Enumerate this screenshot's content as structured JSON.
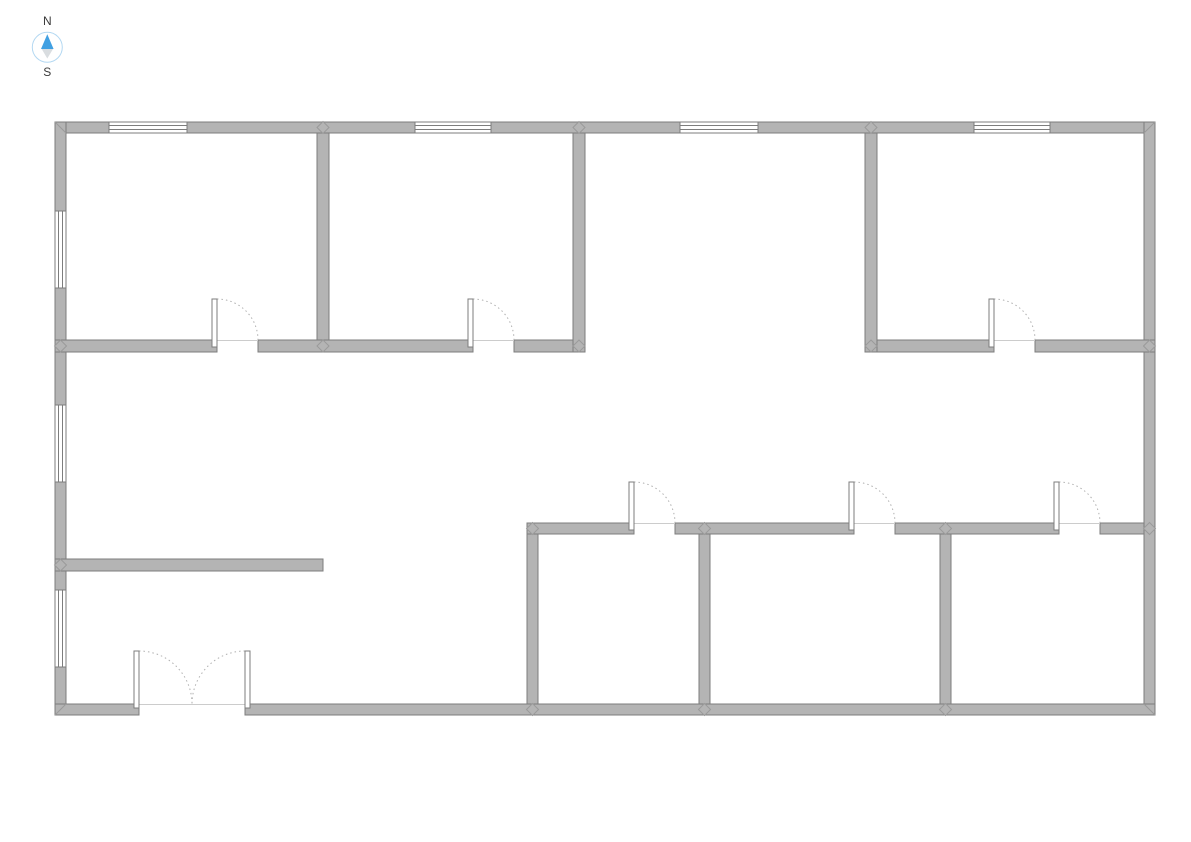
{
  "compass": {
    "north_label": "N",
    "south_label": "S",
    "needle_north_color": "#41a0e2",
    "needle_south_color": "#d9dde0",
    "ring_color": "#b3d8f2",
    "label_color": "#3a3a3a"
  },
  "plan": {
    "colors": {
      "background": "#ffffff",
      "wall_fill": "#b4b4b4",
      "wall_stroke": "#7d7d7d",
      "opening_fill": "#ffffff",
      "door_arc": "#b0b0b0",
      "threshold": "#cccccc",
      "joint_stroke": "#9a9a9a"
    },
    "walls": [
      {
        "name": "outer-wall-north",
        "r": [
          55,
          122,
          1100,
          11
        ]
      },
      {
        "name": "outer-wall-west",
        "r": [
          55,
          122,
          11,
          593
        ]
      },
      {
        "name": "outer-wall-east",
        "r": [
          1144,
          122,
          11,
          593
        ]
      },
      {
        "name": "outer-wall-south-west-segment",
        "r": [
          55,
          704,
          84,
          11
        ]
      },
      {
        "name": "outer-wall-south-east-segment",
        "r": [
          245,
          704,
          910,
          11
        ]
      },
      {
        "name": "partition-upper-west-1",
        "r": [
          55,
          340,
          162,
          12
        ]
      },
      {
        "name": "partition-upper-west-2",
        "r": [
          258,
          340,
          215,
          12
        ]
      },
      {
        "name": "partition-upper-west-3",
        "r": [
          514,
          340,
          71,
          12
        ]
      },
      {
        "name": "partition-upper-east-1",
        "r": [
          865,
          340,
          129,
          12
        ]
      },
      {
        "name": "partition-upper-east-2",
        "r": [
          1035,
          340,
          120,
          12
        ]
      },
      {
        "name": "divider-room1-room2",
        "r": [
          317,
          133,
          12,
          207
        ]
      },
      {
        "name": "divider-room2-hall",
        "r": [
          573,
          133,
          12,
          219
        ]
      },
      {
        "name": "divider-hall-room4",
        "r": [
          865,
          133,
          12,
          219
        ]
      },
      {
        "name": "stub-wall-west",
        "r": [
          55,
          559,
          268,
          12
        ]
      },
      {
        "name": "partition-lower-1",
        "r": [
          527,
          523,
          107,
          11
        ]
      },
      {
        "name": "partition-lower-2",
        "r": [
          675,
          523,
          179,
          11
        ]
      },
      {
        "name": "partition-lower-3",
        "r": [
          895,
          523,
          164,
          11
        ]
      },
      {
        "name": "partition-lower-4",
        "r": [
          1100,
          523,
          44,
          11
        ]
      },
      {
        "name": "divider-room5-west",
        "r": [
          527,
          534,
          11,
          170
        ]
      },
      {
        "name": "divider-room5-room6",
        "r": [
          699,
          534,
          11,
          170
        ]
      },
      {
        "name": "divider-room6-room7",
        "r": [
          940,
          534,
          11,
          170
        ]
      }
    ],
    "windows": [
      {
        "name": "window-north-1",
        "r": [
          109,
          122,
          78,
          11
        ],
        "o": "h"
      },
      {
        "name": "window-north-2",
        "r": [
          415,
          122,
          76,
          11
        ],
        "o": "h"
      },
      {
        "name": "window-north-3",
        "r": [
          680,
          122,
          78,
          11
        ],
        "o": "h"
      },
      {
        "name": "window-north-4",
        "r": [
          974,
          122,
          76,
          11
        ],
        "o": "h"
      },
      {
        "name": "window-west-1",
        "r": [
          55,
          211,
          11,
          77
        ],
        "o": "v"
      },
      {
        "name": "window-west-2",
        "r": [
          55,
          405,
          11,
          77
        ],
        "o": "v"
      },
      {
        "name": "window-west-3",
        "r": [
          55,
          590,
          11,
          77
        ],
        "o": "v"
      }
    ],
    "doors": [
      {
        "name": "door-room1",
        "hinge_x": 217,
        "wall_y": 340,
        "radius": 41,
        "swing": "up-right",
        "leaf": [
          212,
          299,
          5,
          48
        ]
      },
      {
        "name": "door-room2",
        "hinge_x": 473,
        "wall_y": 340,
        "radius": 41,
        "swing": "up-right",
        "leaf": [
          468,
          299,
          5,
          48
        ]
      },
      {
        "name": "door-room4",
        "hinge_x": 994,
        "wall_y": 340,
        "radius": 41,
        "swing": "up-right",
        "leaf": [
          989,
          299,
          5,
          48
        ]
      },
      {
        "name": "door-room5",
        "hinge_x": 634,
        "wall_y": 523,
        "radius": 41,
        "swing": "up-right",
        "leaf": [
          629,
          482,
          5,
          48
        ]
      },
      {
        "name": "door-room6",
        "hinge_x": 854,
        "wall_y": 523,
        "radius": 41,
        "swing": "up-right",
        "leaf": [
          849,
          482,
          5,
          48
        ]
      },
      {
        "name": "door-room7",
        "hinge_x": 1059,
        "wall_y": 523,
        "radius": 41,
        "swing": "up-right",
        "leaf": [
          1054,
          482,
          5,
          48
        ]
      },
      {
        "name": "entrance-door-left-leaf",
        "hinge_x": 139,
        "wall_y": 704,
        "radius": 53,
        "swing": "up-right",
        "leaf": [
          134,
          651,
          5,
          57
        ]
      },
      {
        "name": "entrance-door-right-leaf",
        "hinge_x": 245,
        "wall_y": 704,
        "radius": 53,
        "swing": "up-left",
        "leaf": [
          245,
          651,
          5,
          57
        ]
      }
    ],
    "thresholds": [
      [
        217,
        340,
        258,
        340
      ],
      [
        473,
        340,
        514,
        340
      ],
      [
        994,
        340,
        1035,
        340
      ],
      [
        634,
        523,
        675,
        523
      ],
      [
        854,
        523,
        895,
        523
      ],
      [
        1059,
        523,
        1100,
        523
      ],
      [
        139,
        704,
        245,
        704
      ]
    ],
    "corner_miters": [
      [
        55,
        122,
        66,
        133
      ],
      [
        1155,
        122,
        1144,
        133
      ],
      [
        55,
        715,
        66,
        704
      ],
      [
        1155,
        715,
        1144,
        704
      ]
    ],
    "joints": [
      [
        323,
        127.5
      ],
      [
        579,
        127.5
      ],
      [
        871,
        127.5
      ],
      [
        323,
        346
      ],
      [
        579,
        346
      ],
      [
        871,
        346
      ],
      [
        60.5,
        346
      ],
      [
        1149.5,
        346
      ],
      [
        60.5,
        565
      ],
      [
        532.5,
        528.5
      ],
      [
        704.5,
        528.5
      ],
      [
        945.5,
        528.5
      ],
      [
        1149.5,
        528.5
      ],
      [
        532.5,
        709.5
      ],
      [
        704.5,
        709.5
      ],
      [
        945.5,
        709.5
      ]
    ]
  }
}
